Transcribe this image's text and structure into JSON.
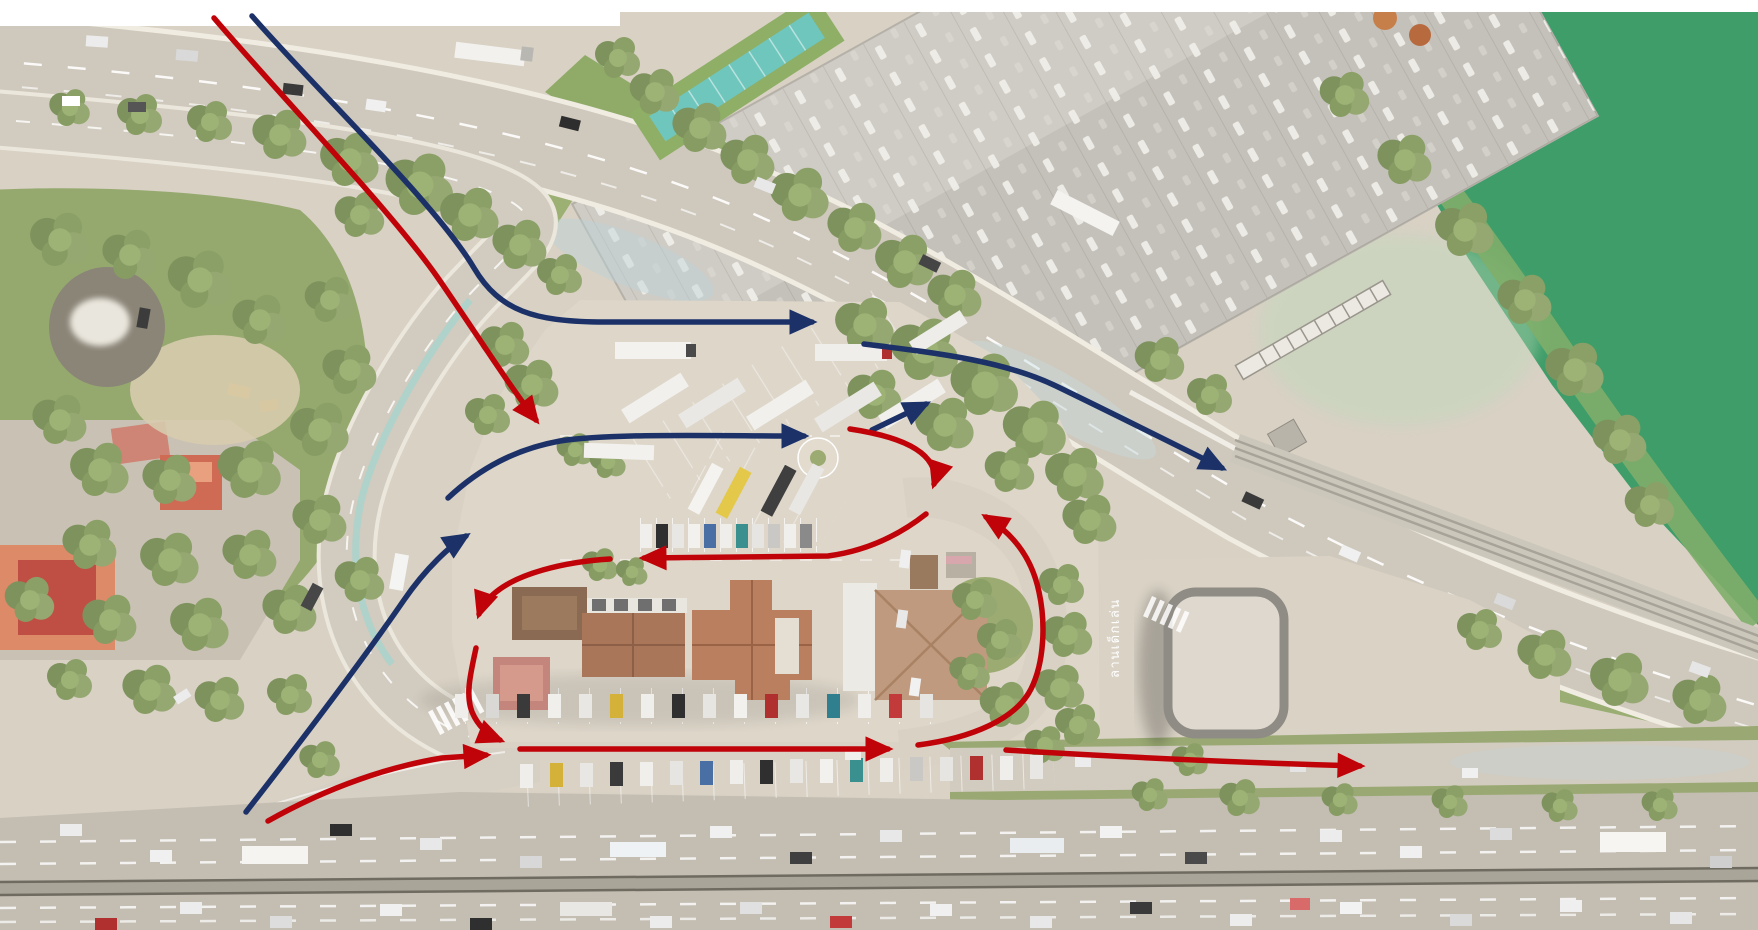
{
  "map": {
    "area_label": "ลานเด็กเล่น",
    "colors": {
      "red_route": "#C00309",
      "blue_route": "#1B3168",
      "water": "#3F9D69",
      "pavement": "#DDD6C9",
      "tree": "#879C63"
    },
    "arrow_counts": {
      "red": 9,
      "blue": 5
    }
  }
}
